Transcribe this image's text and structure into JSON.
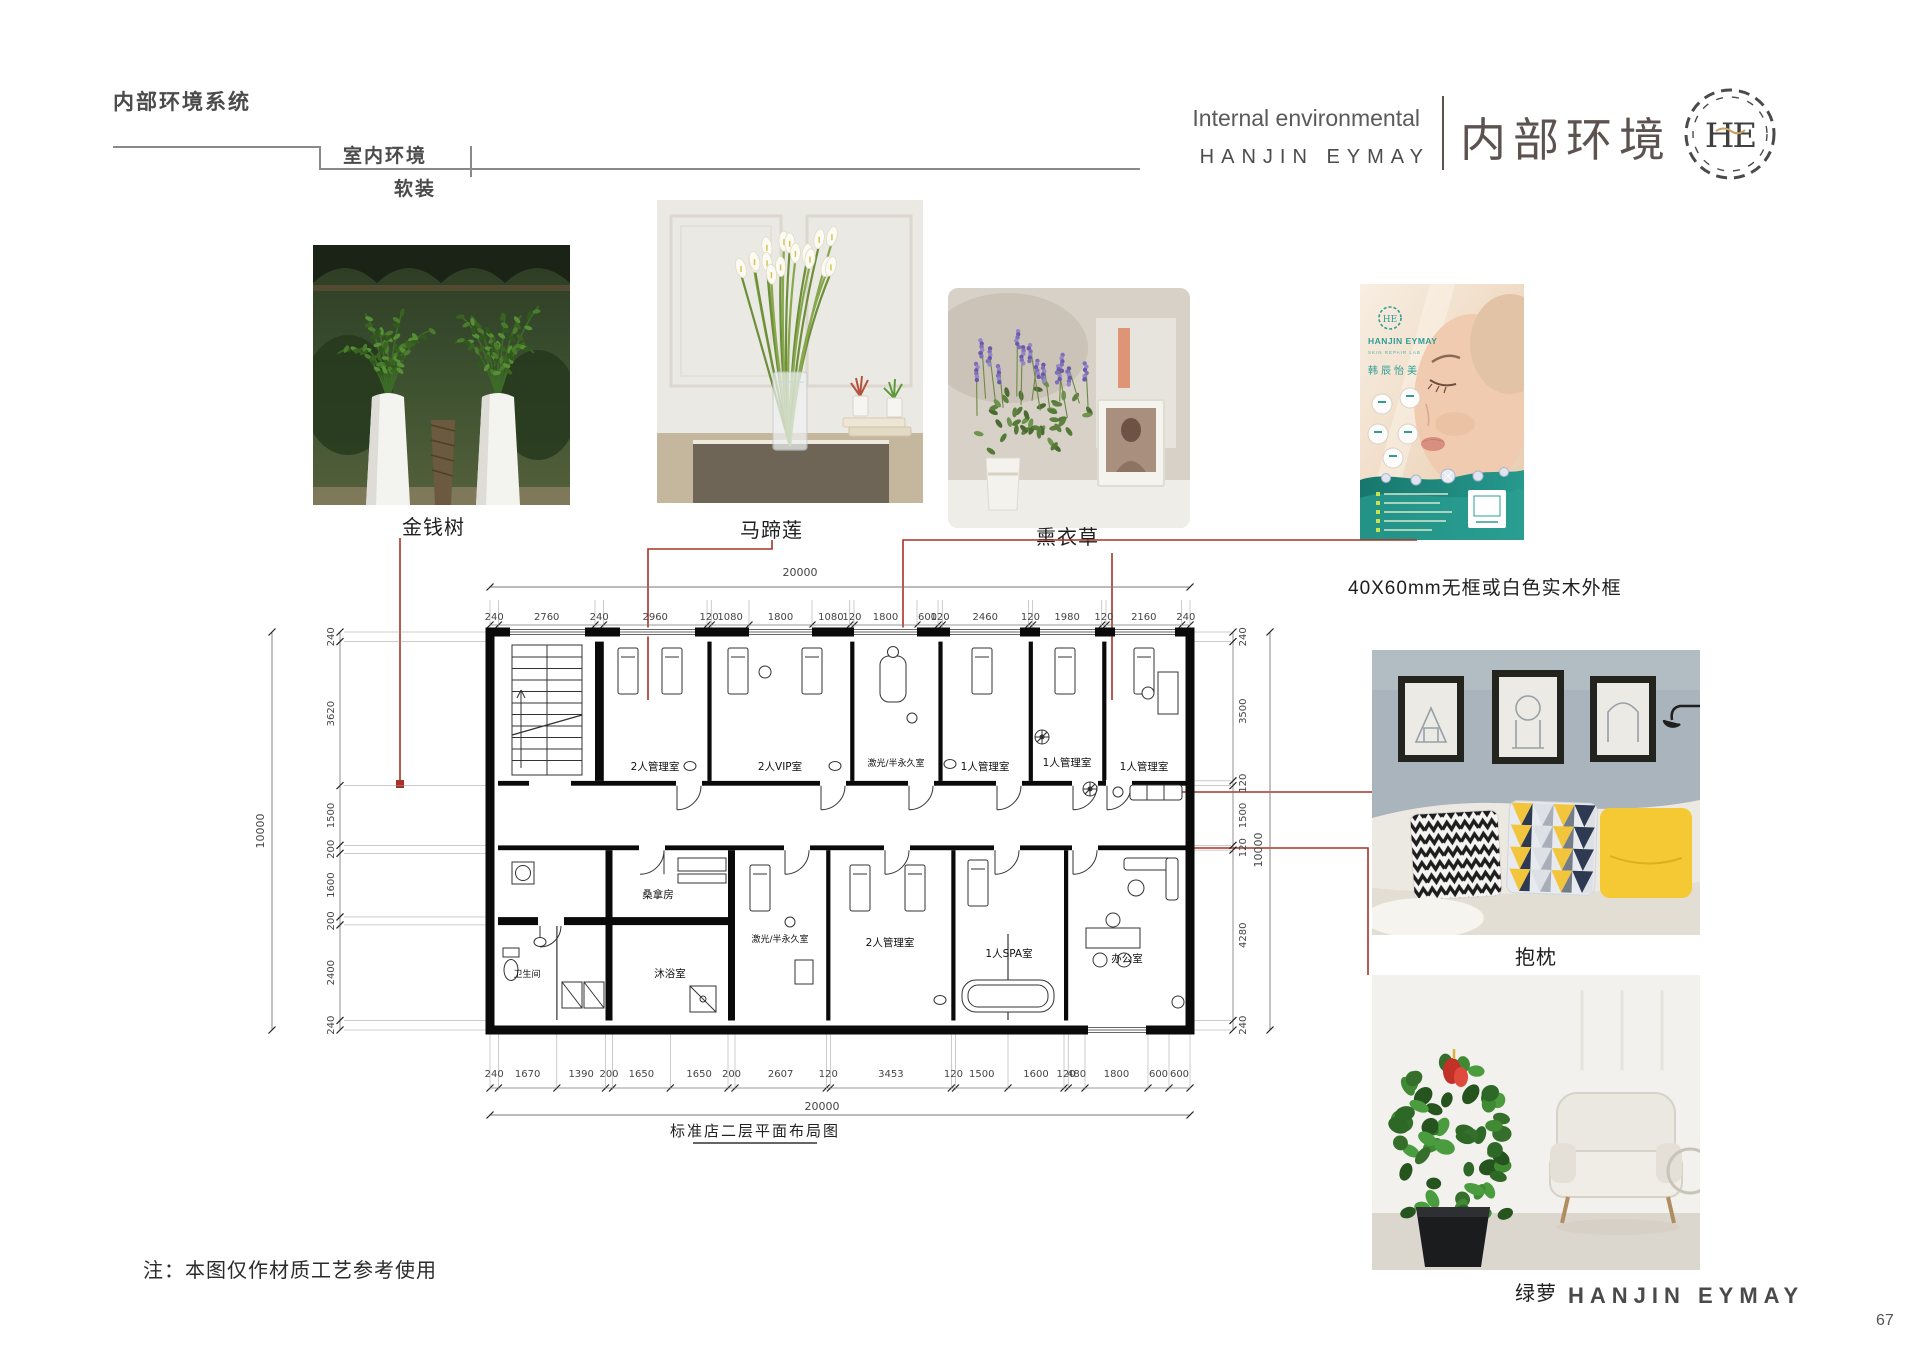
{
  "header": {
    "breadcrumb": {
      "level1": "内部环境系统",
      "level2": "室内环境",
      "level3": "软装"
    },
    "title_en": "Internal environmental",
    "brand_en": "HANJIN EYMAY",
    "title_cn": "内部环境",
    "logo_monogram": "HE"
  },
  "labels": {
    "item1": "金钱树",
    "item2": "马蹄莲",
    "item3": "熏衣草",
    "item4": "40X60mm无框或白色实木外框",
    "item5": "抱枕",
    "item6": "绿萝"
  },
  "poster": {
    "brand": "HANJIN EYMAY",
    "sub_brand": "韩辰怡美"
  },
  "floor_plan": {
    "caption": "标准店二层平面布局图",
    "total_width_mm": "20000",
    "total_height_mm": "10000",
    "dims_top": [
      240,
      2760,
      240,
      2960,
      120,
      1080,
      1800,
      1080,
      120,
      1800,
      600,
      120,
      2460,
      120,
      1980,
      120,
      2160,
      240
    ],
    "dims_bottom": [
      240,
      1670,
      1390,
      200,
      1650,
      1650,
      200,
      2607,
      120,
      3453,
      120,
      1500,
      1600,
      120,
      480,
      1800,
      600,
      600
    ],
    "dims_left": [
      240,
      3620,
      1500,
      200,
      1600,
      200,
      2400,
      240
    ],
    "dims_right": [
      240,
      3500,
      120,
      1500,
      120,
      4280,
      240
    ],
    "top_rooms": [
      "2人管理室",
      "2人VIP室",
      "激光/半永久室",
      "1人管理室",
      "1人管理室",
      "1人管理室"
    ],
    "bottom_rooms": [
      "卫生间",
      "沐浴室",
      "桑拿房",
      "激光/半永久室",
      "2人管理室",
      "1人SPA室",
      "办公室"
    ]
  },
  "footer": {
    "note": "注：本图仅作材质工艺参考使用",
    "brand": "HANJIN EYMAY",
    "page_number": "67"
  },
  "colors": {
    "accent_red": "#a93226",
    "teal": "#1e8b81",
    "yellow": "#f4c934"
  }
}
